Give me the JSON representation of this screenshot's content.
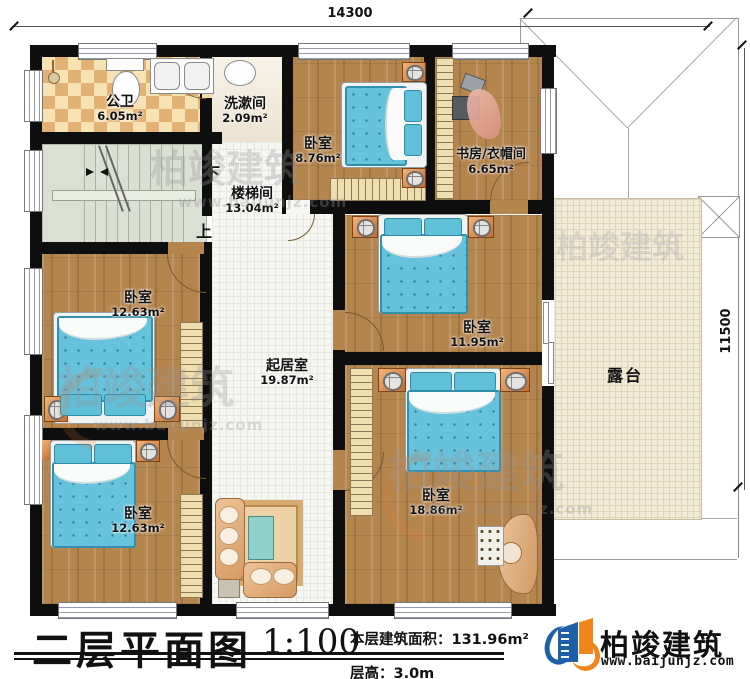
{
  "plan": {
    "dimensions": {
      "top": "14300",
      "right": "11500"
    },
    "rooms": {
      "bath": {
        "name": "公卫",
        "area": "6.05m²"
      },
      "washroom": {
        "name": "洗漱间",
        "area": "2.09m²"
      },
      "stairwell": {
        "name": "楼梯间",
        "area": "13.04m²",
        "down_label": "下",
        "up_label": "上"
      },
      "bedroom_top": {
        "name": "卧室",
        "area": "8.76m²"
      },
      "study": {
        "name": "书房/衣帽间",
        "area": "6.65m²"
      },
      "bedroom_mid_left": {
        "name": "卧室",
        "area": "12.63m²"
      },
      "bedroom_bottom_left": {
        "name": "卧室",
        "area": "12.63m²"
      },
      "living_room": {
        "name": "起居室",
        "area": "19.87m²"
      },
      "bedroom_mid": {
        "name": "卧室",
        "area": "11.95m²"
      },
      "bedroom_master": {
        "name": "卧室",
        "area": "18.86m²"
      },
      "terrace": {
        "name": "露台"
      }
    }
  },
  "title_block": {
    "title": "二层平面图",
    "scale": "1:100",
    "floor_area_label": "本层建筑面积：131.96m²",
    "floor_height_label": "层高：3.0m"
  },
  "brand": {
    "name": "柏竣建筑",
    "website": "www.baijunjz.com"
  },
  "colors": {
    "brand_blue": "#1e5fa8",
    "brand_orange": "#f08519",
    "wall": "#0e0e0e",
    "wood_floor": "#b5854e",
    "mattress_blue": "#67c3dc",
    "terrace_floor": "#f1ebd8"
  }
}
